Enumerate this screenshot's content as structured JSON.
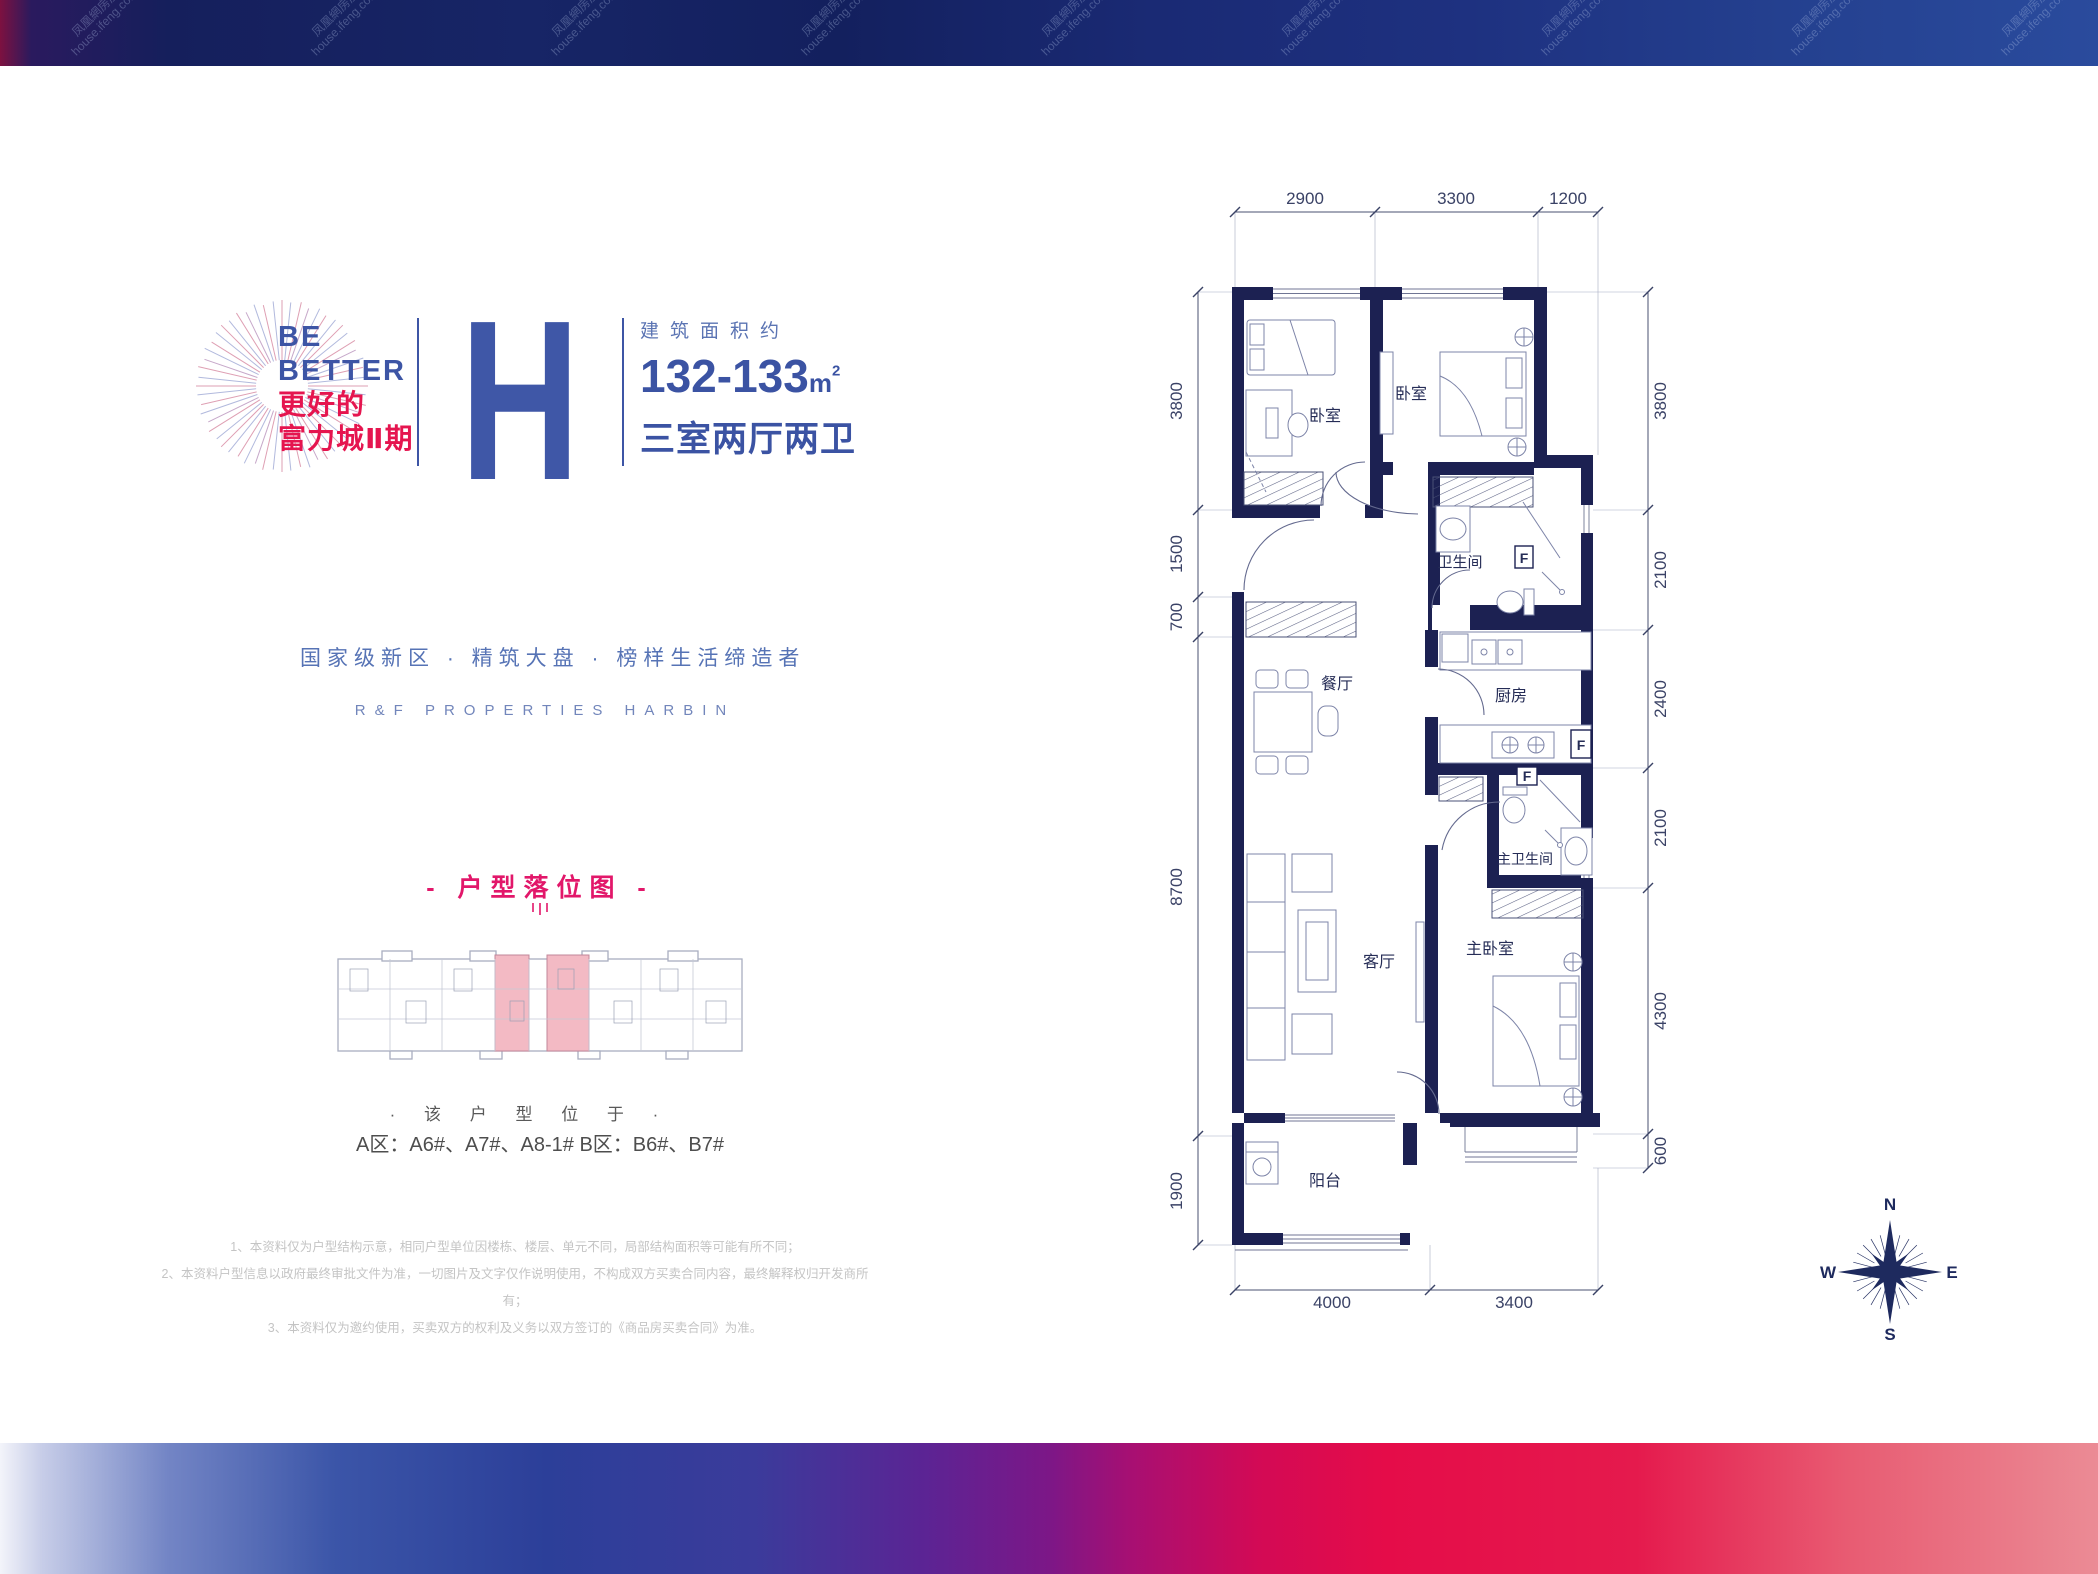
{
  "watermark": {
    "cn": "凤凰網房産",
    "en": "house.ifeng.com"
  },
  "brand": {
    "line1": "BE",
    "line2": "BETTER",
    "line3": "更好的",
    "line4": "富力城Ⅱ期"
  },
  "unit": {
    "letter": "H",
    "area_label": "建筑面积约",
    "area_value": "132-133",
    "area_unit": "m",
    "area_sup": "2",
    "rooms_label": "三室两厅两卫"
  },
  "tagline": {
    "cn": "国家级新区 · 精筑大盘 · 榜样生活缔造者",
    "en": "R&F PROPERTIES HARBIN"
  },
  "locator": {
    "title": "- 户型落位图 -",
    "note": "· 该 户 型 位 于 ·",
    "buildings": "A区：A6#、A7#、A8-1#   B区：B6#、B7#"
  },
  "disclaimers": [
    "1、本资料仅为户型结构示意，相同户型单位因楼栋、楼层、单元不同，局部结构面积等可能有所不同；",
    "2、本资料户型信息以政府最终审批文件为准，一切图片及文字仅作说明使用，不构成双方买卖合同内容，最终解释权归开发商所有；",
    "3、本资料仅为邀约使用，买卖双方的权利及义务以双方签订的《商品房买卖合同》为准。"
  ],
  "floorplan": {
    "rooms": {
      "bedroom1": "卧室",
      "bedroom2": "卧室",
      "bathroom": "卫生间",
      "dining": "餐厅",
      "kitchen": "厨房",
      "master_bath": "主卫生间",
      "living": "客厅",
      "master_bedroom": "主卧室",
      "balcony": "阳台"
    },
    "appliance_marks": {
      "f1": "F",
      "f2": "F",
      "f3": "F"
    },
    "dims": {
      "top": [
        "2900",
        "3300",
        "1200"
      ],
      "left": [
        "3800",
        "1500",
        "700",
        "8700",
        "1900"
      ],
      "right": [
        "3800",
        "2100",
        "2400",
        "2100",
        "4300",
        "600"
      ],
      "bottom": [
        "4000",
        "3400"
      ]
    },
    "compass": {
      "n": "N",
      "e": "E",
      "s": "S",
      "w": "W"
    }
  },
  "colors": {
    "accent_blue": "#3d55a5",
    "accent_pink": "#e2176a",
    "wall_navy": "#1c2152"
  }
}
